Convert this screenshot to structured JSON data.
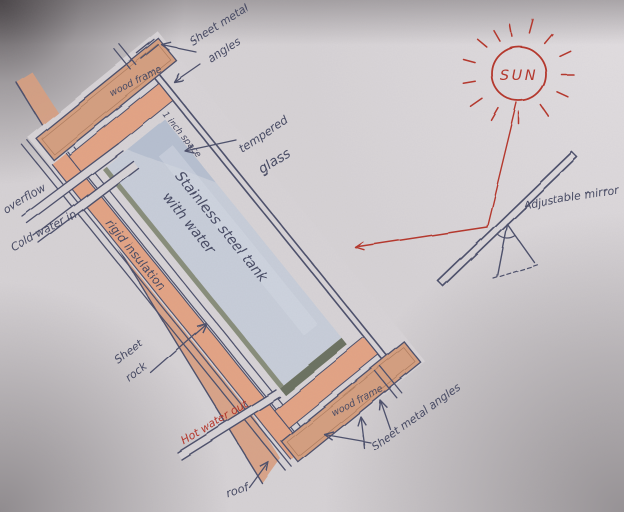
{
  "labels": {
    "sun": "SUN",
    "adjustable_mirror": "Adjustable mirror",
    "sheet_metal_angles_top": {
      "line1": "Sheet metal",
      "line2": "angles"
    },
    "wood_frame_top": "wood frame",
    "one_inch_space": "1 inch space",
    "tempered_glass": {
      "line1": "tempered",
      "line2": "glass"
    },
    "tank": {
      "line1": "Stainless steel tank",
      "line2": "with water"
    },
    "rigid_insulation": "rigid insulation",
    "sheet_rock": {
      "line1": "Sheet",
      "line2": "rock"
    },
    "overflow": "overflow",
    "cold_water_in": "Cold water in",
    "hot_water_out": "Hot water out",
    "roof": "roof",
    "wood_frame_bottom": "wood frame",
    "sheet_metal_angles_bottom": "Sheet metal angles"
  },
  "colors": {
    "ink": "#4c4f6b",
    "red": "#b5352a",
    "paper": "#d6d2d5",
    "wood_frame": "#d49e7f",
    "insulation": "#e3a384",
    "roof_plank": "#d89e80",
    "tank_water": "#c7cdd9"
  }
}
